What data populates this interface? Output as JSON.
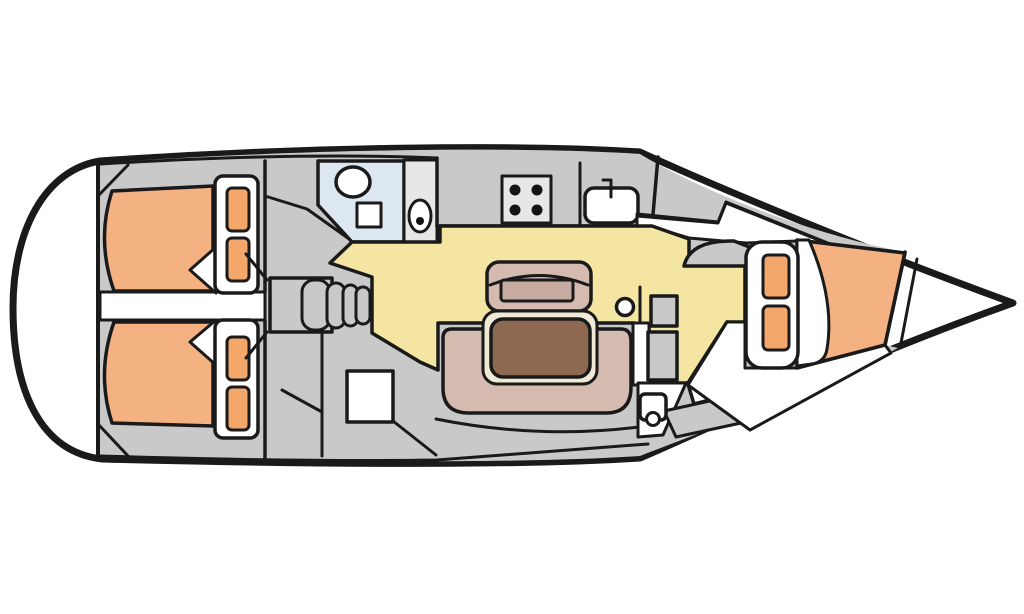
{
  "diagram": {
    "type": "sailboat-interior-floor-plan",
    "orientation": "bow-right"
  },
  "colors": {
    "outline": "#1a1a1a",
    "hull_fill": "#ffffff",
    "interior": "#c9c9c9",
    "panel_light": "#e7e7e7",
    "fixture_white": "#ffffff",
    "head_floor": "#dde7f0",
    "saloon_floor": "#f4e5a3",
    "berth": "#f4b182",
    "pillow": "#f3a76b",
    "upholstery": "#d5bab0",
    "cushion": "#c7aba0",
    "table_top": "#8d6952",
    "table_edge": "#f0e9d6",
    "burner": "#141414"
  },
  "galley": {
    "burner_count": 4
  }
}
